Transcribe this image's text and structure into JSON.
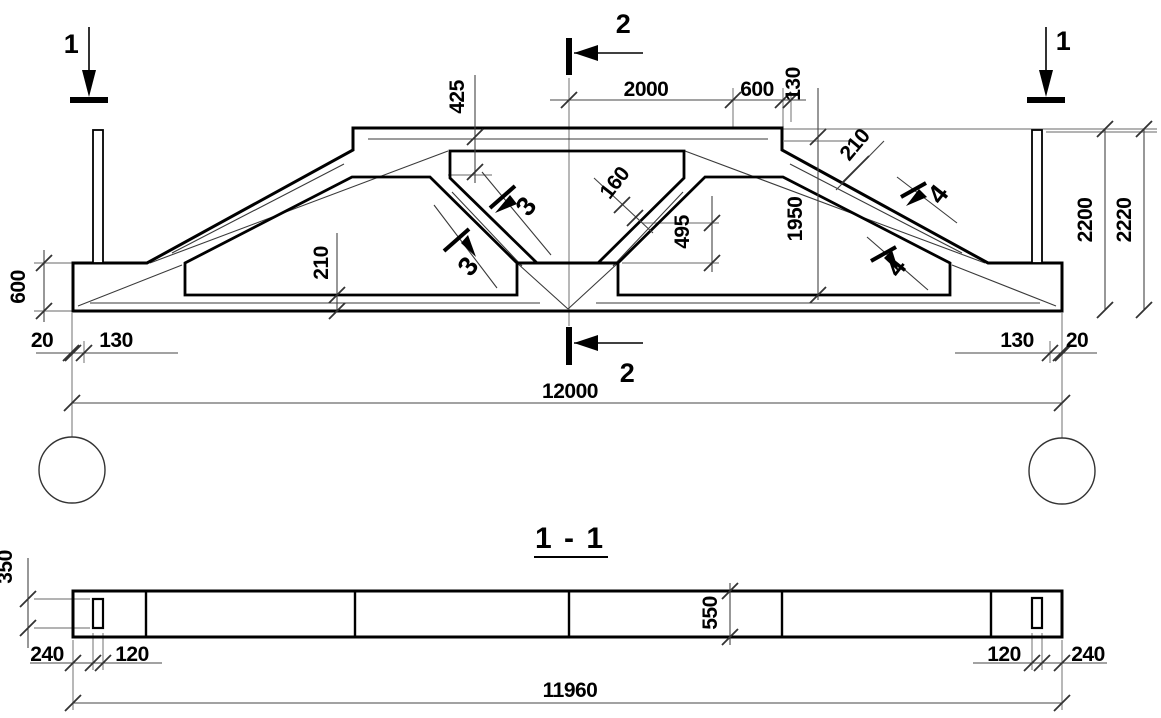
{
  "drawing": {
    "kind": "reinforced concrete truss working drawing",
    "colors": {
      "line": "#000000",
      "thin": "#3a3a3a",
      "grey": "#9a9a9a",
      "background": "#ffffff"
    },
    "elevation": {
      "markers": {
        "cut1_left": "1",
        "cut1_right": "1",
        "cut2_top": "2",
        "cut2_bottom": "2",
        "cut3_upper": "3",
        "cut3_lower": "3",
        "cut4_upper": "4",
        "cut4_lower": "4"
      },
      "dims": {
        "slab_height": "425",
        "top_mid": "2000",
        "top_right": "600",
        "top_edge": "130",
        "slope_thickness": "210",
        "web_thickness": "160",
        "mid_height": "1950",
        "web_drop": "495",
        "chord_thickness": "210",
        "end_height": "600",
        "gap_left": "20",
        "seat_left": "130",
        "seat_right": "130",
        "gap_right": "20",
        "span": "12000",
        "height_inner": "2200",
        "height_total": "2220"
      }
    },
    "section": {
      "title": "1 - 1",
      "dims": {
        "hole_length": "350",
        "end_offset_left": "240",
        "hole_width_left": "120",
        "depth": "550",
        "hole_width_right": "120",
        "end_offset_right": "240",
        "length": "11960"
      }
    }
  }
}
